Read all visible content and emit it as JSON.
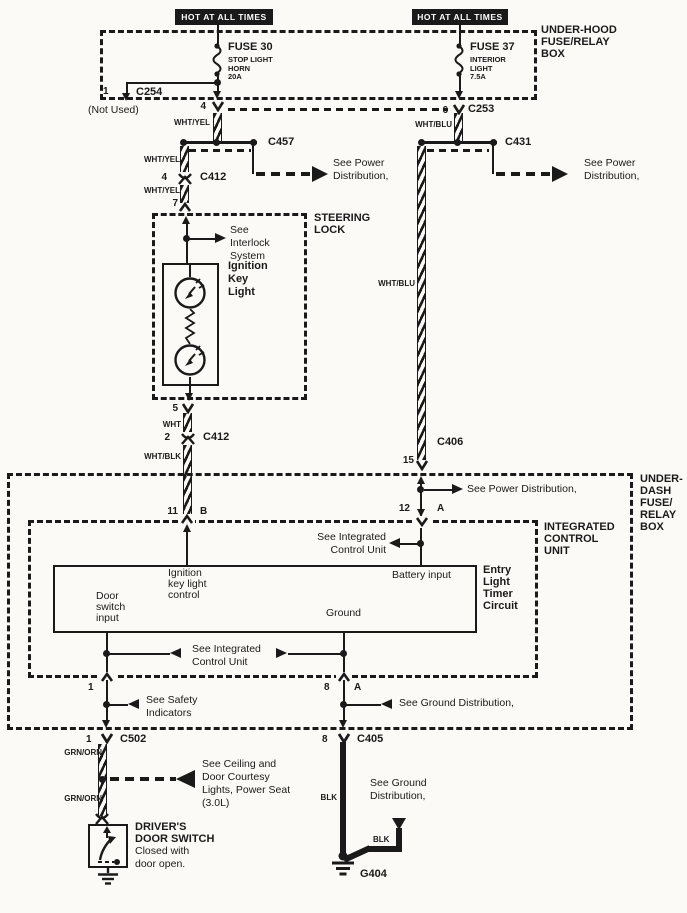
{
  "banners": {
    "left": "HOT AT ALL TIMES",
    "right": "HOT AT ALL TIMES"
  },
  "underhood": {
    "label": [
      "UNDER-HOOD",
      "FUSE/RELAY",
      "BOX"
    ],
    "fuse30": {
      "name": "FUSE 30",
      "lines": [
        "STOP LIGHT",
        "HORN",
        "20A"
      ]
    },
    "fuse37": {
      "name": "FUSE 37",
      "lines": [
        "INTERIOR",
        "LIGHT",
        "7.5A"
      ]
    },
    "c254": {
      "pin": "1",
      "name": "C254",
      "note": "(Not Used)"
    },
    "exit_left_pin": "4",
    "exit_right_pin": "6",
    "c253": "C253"
  },
  "power_left": {
    "wire1": "WHT/YEL",
    "wire2": "WHT/YEL",
    "wire3": "WHT/YEL",
    "c457": "C457",
    "see_power": [
      "See Power",
      "Distribution,"
    ],
    "c412": {
      "pin": "4",
      "name": "C412"
    },
    "steering_pin": "7"
  },
  "power_right": {
    "wire_top": "WHT/BLU",
    "wire_mid": "WHT/BLU",
    "c431": "C431",
    "see_power": [
      "See Power",
      "Distribution,"
    ],
    "c406": {
      "pin": "15",
      "name": "C406"
    }
  },
  "steering": {
    "label": [
      "STEERING",
      "LOCK"
    ],
    "see_interlock": [
      "See",
      "Interlock",
      "System"
    ],
    "lamp_label": [
      "Ignition",
      "Key",
      "Light"
    ],
    "exit_pin": "5",
    "wire": "WHT",
    "c412": {
      "pin": "2",
      "name": "C412"
    },
    "wire_out": "WHT/BLK"
  },
  "underdash": {
    "label": [
      "UNDER-",
      "DASH",
      "FUSE/",
      "RELAY",
      "BOX"
    ],
    "see_power": "See Power Distribution,",
    "pin12": {
      "pin": "12",
      "term": "A"
    },
    "pin11": {
      "pin": "11",
      "term": "B"
    }
  },
  "icu": {
    "label": [
      "INTEGRATED",
      "CONTROL",
      "UNIT"
    ],
    "see_icu_right": [
      "See Integrated",
      "Control Unit"
    ],
    "timer": [
      "Entry",
      "Light",
      "Timer",
      "Circuit"
    ],
    "ecu": {
      "ign": [
        "Ignition",
        "key light",
        "control"
      ],
      "battery": "Battery input",
      "door": [
        "Door",
        "switch",
        "input"
      ],
      "ground": "Ground"
    },
    "see_icu_bottom": [
      "See  Integrated",
      "Control Unit"
    ],
    "exit_left": "1",
    "exit_right": {
      "pin": "8",
      "term": "A"
    },
    "see_safety": [
      "See Safety",
      "Indicators"
    ],
    "see_ground": "See Ground Distribution,"
  },
  "bottom": {
    "c502": {
      "pin": "1",
      "name": "C502"
    },
    "c405": {
      "pin": "8",
      "name": "C405"
    },
    "wire_grn1": "GRN/ORN",
    "wire_grn2": "GRN/ORN",
    "see_ceiling": [
      "See Ceiling and",
      "Door Courtesy",
      "Lights, Power Seat",
      "(3.0L)"
    ],
    "door_switch": [
      "DRIVER'S",
      "DOOR SWITCH",
      "Closed with",
      "door open."
    ],
    "wire_blk": "BLK",
    "wire_blk2": "BLK",
    "see_ground": [
      "See Ground",
      "Distribution,"
    ],
    "g404": "G404"
  }
}
